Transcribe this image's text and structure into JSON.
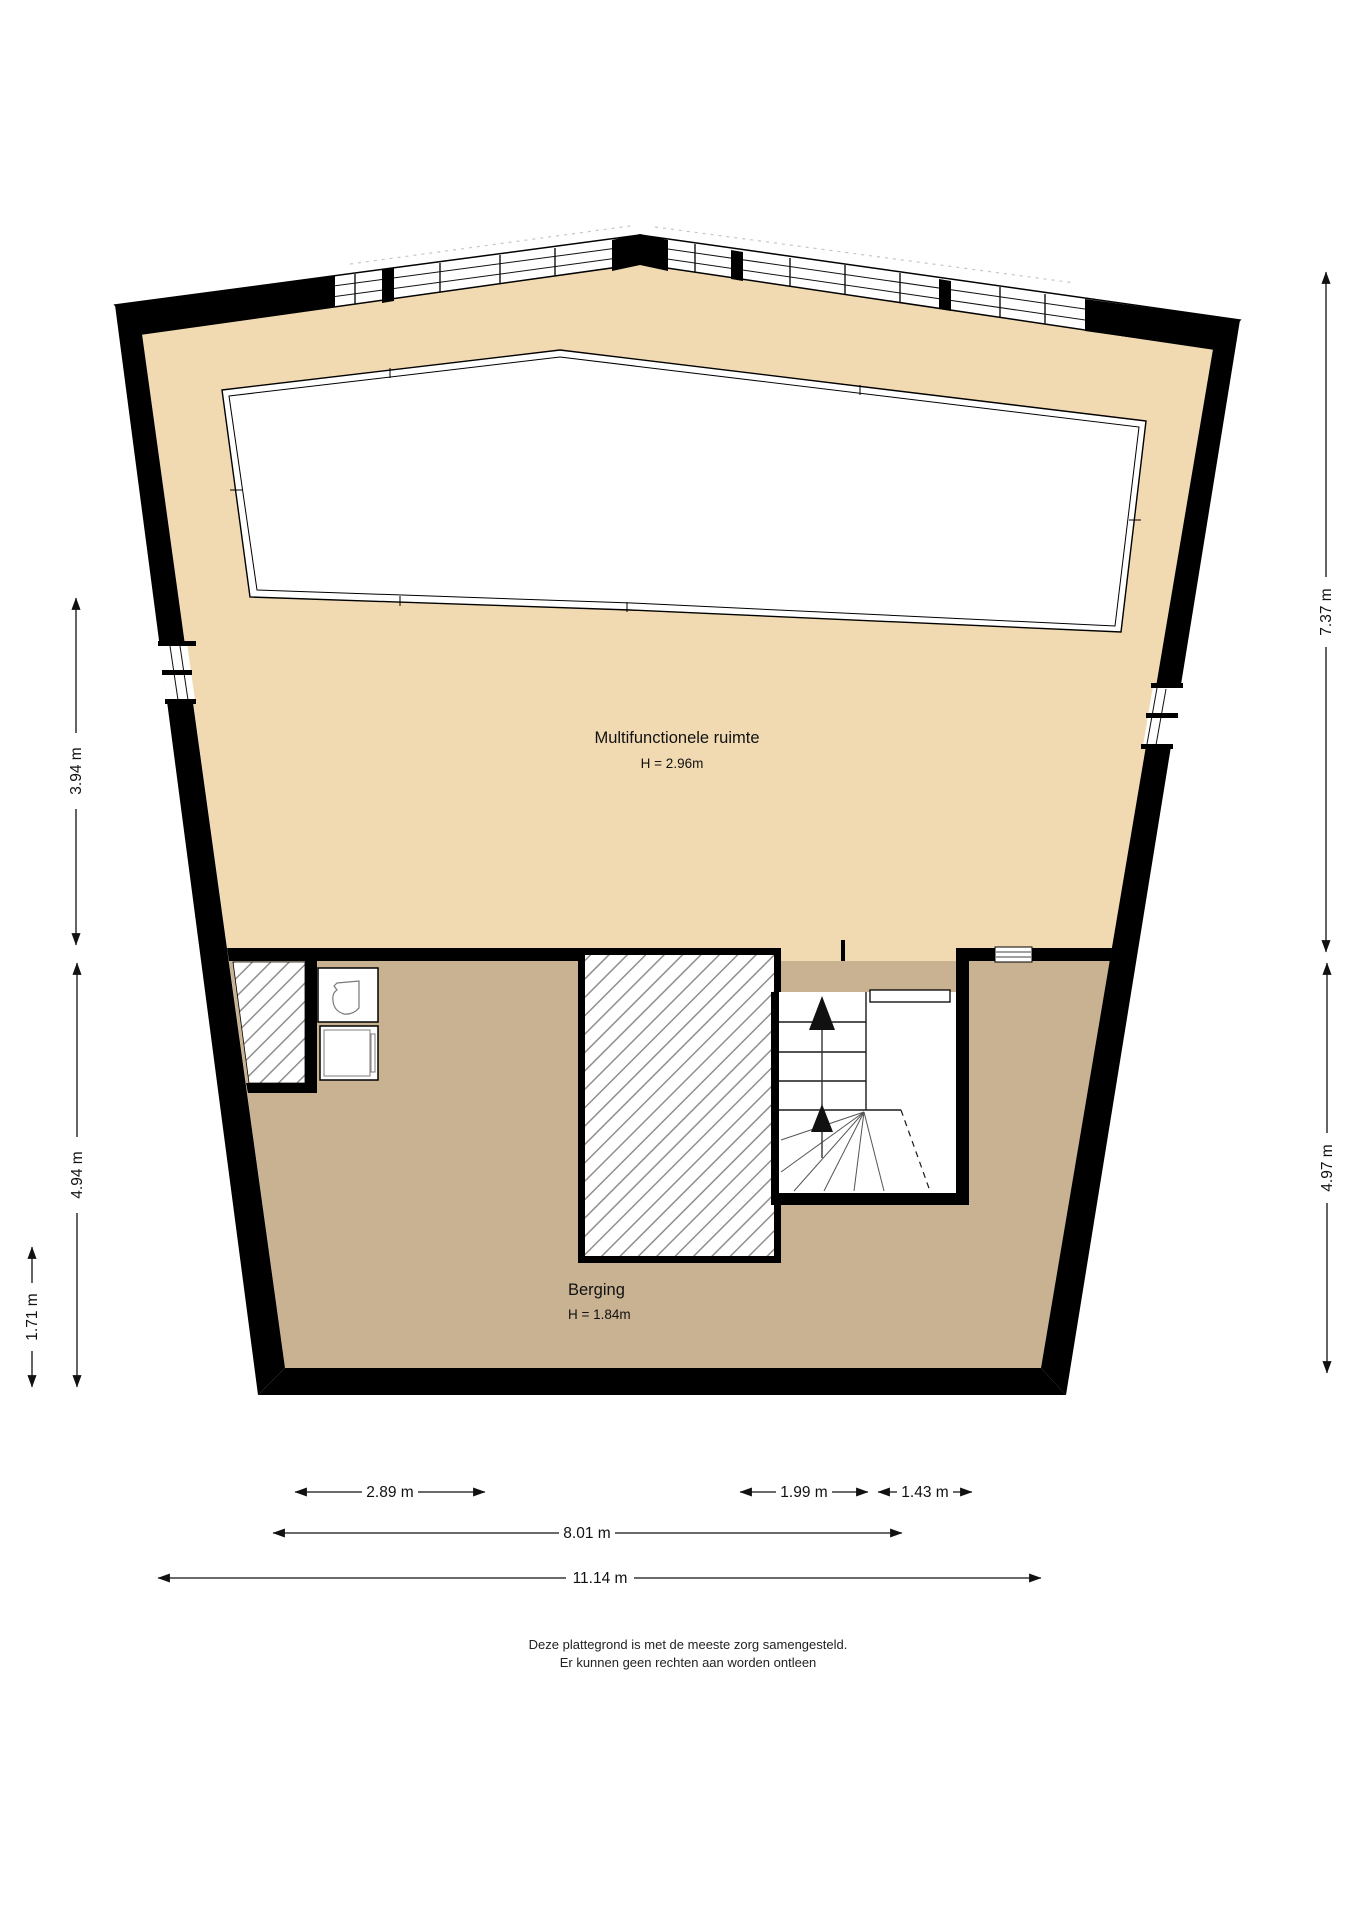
{
  "rooms": {
    "multifunctionele": {
      "name": "Multifunctionele ruimte",
      "height": "H = 2.96m"
    },
    "berging": {
      "name": "Berging",
      "height": "H = 1.84m"
    }
  },
  "dimensions": {
    "left": [
      {
        "label": "3.94 m"
      },
      {
        "label": "4.94 m"
      },
      {
        "label": "1.71 m"
      }
    ],
    "right": [
      {
        "label": "7.37 m"
      },
      {
        "label": "4.97 m"
      }
    ],
    "bottom": [
      {
        "label": "2.89 m"
      },
      {
        "label": "1.99 m"
      },
      {
        "label": "1.43 m"
      },
      {
        "label": "8.01 m"
      },
      {
        "label": "11.14 m"
      }
    ]
  },
  "footer": {
    "line1": "Deze plattegrond is met de meeste zorg samengesteld.",
    "line2": "Er kunnen geen rechten aan worden ontleen"
  },
  "colors": {
    "wall": "#000000",
    "room_upper_floor": "#f1dab1",
    "room_lower_floor": "#c8b292",
    "hatch_line": "#8f8f8f",
    "dimension_text": "#111111"
  }
}
